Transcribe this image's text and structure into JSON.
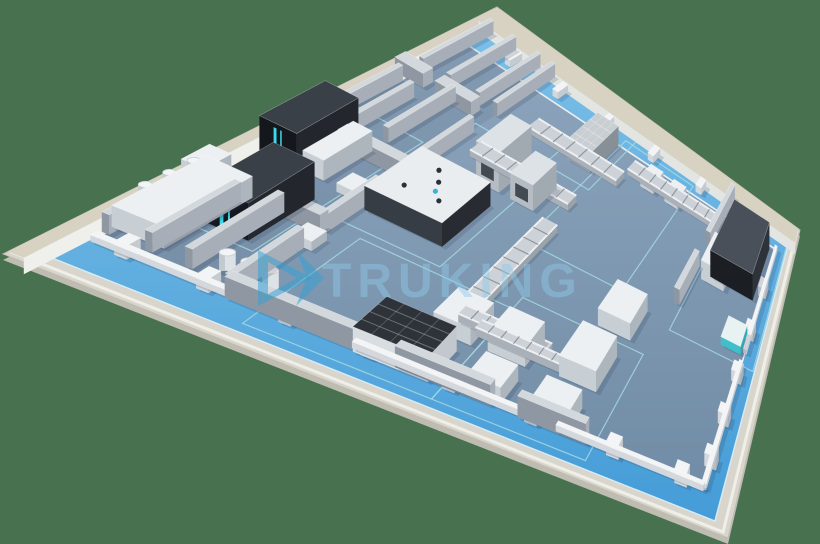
{
  "watermark": {
    "text": "TRUKING"
  },
  "scene": {
    "background_color": "#48714F",
    "corners": {
      "left": [
        3,
        254
      ],
      "top": [
        497,
        7
      ],
      "right": [
        800,
        230
      ],
      "bottom": [
        728,
        538
      ]
    },
    "colors": {
      "slab": "#D8D5CC",
      "slab_side": "#BFBCB2",
      "slab_lip": "#EFEEE7",
      "walkway_far": "#79BEE7",
      "walkway_near": "#459CD7",
      "walkway_line": "#D7ECF7",
      "floor_far": "#8CA4BC",
      "floor_near": "#708CA6",
      "floor_near_fix": "#718CA6",
      "curb": "#ECEEF0",
      "perimeter_top": "#D8D2C3",
      "perimeter_face": "#EFF0EB",
      "perimeter_face_far": "#E2E5E2",
      "marking": "#A5D8E2",
      "shadow": "rgba(35,50,70,0.17)",
      "glow": "#3FE3F6",
      "logo_blue": "#2E9FD6",
      "watermark_fill": "#8FCAEA"
    },
    "palettes": {
      "white": {
        "top": "#EDF0F2",
        "near": "#C7CED4",
        "side": "#ADB5BD"
      },
      "dark": {
        "top": "#3A4047",
        "near": "#14171C",
        "side": "#23272D"
      },
      "isolator": {
        "top": "#E9EDEF",
        "near": "#373D44",
        "side": "#282C32"
      },
      "frame": {
        "top": "#DDE2E6",
        "near": "#B5BCC3",
        "side": "#A1A9B1"
      },
      "crate": {
        "top": "#C9CED3",
        "near": "#99A1A9",
        "side": "#878F97"
      },
      "cartoner": {
        "top": "#4A5059",
        "near": "#1B1F24",
        "side": "#2E333A"
      },
      "agv": {
        "top": "#E8F2F2",
        "near": "#3FBFC9",
        "side": "#2FA9B4"
      },
      "tunnel": {
        "top": "#2E3339",
        "near": "#D8DDE1",
        "side": "#C2C8CE"
      },
      "wall": {
        "top": "#D3D8DD",
        "near": "#8F98A2",
        "side": "#A7AEB7"
      },
      "wallLow": {
        "top": "#F3F4F5",
        "near": "#D4D8DC",
        "side": "#C5CACF"
      }
    },
    "insets": {
      "walkway": {
        "u1": 0.022,
        "v1": 0.035,
        "u2": 0.978,
        "v2": 0.955
      },
      "floor": {
        "u1": 0.05,
        "v1": 0.115,
        "u2": 0.952,
        "v2": 0.9
      }
    },
    "perimeter_walls": [
      {
        "id": "perimeter-wall-left",
        "side": "u",
        "edge": 0.022,
        "band": 0.022,
        "h": 20
      },
      {
        "id": "perimeter-wall-far",
        "side": "v",
        "edge": 0.955,
        "band": 0.045,
        "h": 18
      }
    ],
    "rooms_walls": [
      {
        "id": "divider-wall-1",
        "u1": 0.25,
        "v1": 0.115,
        "u2": 0.25,
        "v2": 0.3
      },
      {
        "id": "divider-wall-2",
        "u1": 0.25,
        "v1": 0.36,
        "u2": 0.25,
        "v2": 0.5
      },
      {
        "id": "divider-wall-3",
        "u1": 0.25,
        "v1": 0.58,
        "u2": 0.25,
        "v2": 0.74
      },
      {
        "id": "divider-wall-4",
        "u1": 0.25,
        "v1": 0.8,
        "u2": 0.25,
        "v2": 0.95
      },
      {
        "id": "room-wall-h1",
        "u1": 0.03,
        "v1": 0.78,
        "u2": 0.1,
        "v2": 0.78
      },
      {
        "id": "room-wall-h2",
        "u1": 0.13,
        "v1": 0.78,
        "u2": 0.22,
        "v2": 0.78
      },
      {
        "id": "room-wall-h3",
        "u1": 0.03,
        "v1": 0.57,
        "u2": 0.09,
        "v2": 0.57
      },
      {
        "id": "room-wall-h4",
        "u1": 0.12,
        "v1": 0.57,
        "u2": 0.25,
        "v2": 0.57
      },
      {
        "id": "room-wall-h5",
        "u1": 0.03,
        "v1": 0.36,
        "u2": 0.12,
        "v2": 0.36
      },
      {
        "id": "room-wall-h6",
        "u1": 0.155,
        "v1": 0.36,
        "u2": 0.25,
        "v2": 0.36
      },
      {
        "id": "room-wall-v1",
        "u1": 0.055,
        "v1": 0.6,
        "u2": 0.055,
        "v2": 0.76
      },
      {
        "id": "room-wall-v2",
        "u1": 0.105,
        "v1": 0.6,
        "u2": 0.105,
        "v2": 0.74
      },
      {
        "id": "room-wall-v3",
        "u1": 0.165,
        "v1": 0.62,
        "u2": 0.165,
        "v2": 0.78
      },
      {
        "id": "room-wall-v4",
        "u1": 0.06,
        "v1": 0.8,
        "u2": 0.06,
        "v2": 0.95
      },
      {
        "id": "room-wall-v5",
        "u1": 0.13,
        "v1": 0.8,
        "u2": 0.13,
        "v2": 0.95
      },
      {
        "id": "room-wall-v6",
        "u1": 0.205,
        "v1": 0.8,
        "u2": 0.205,
        "v2": 0.95
      },
      {
        "id": "room-wall-v7",
        "u1": 0.05,
        "v1": 0.14,
        "u2": 0.05,
        "v2": 0.34
      },
      {
        "id": "room-wall-v8",
        "u1": 0.115,
        "v1": 0.14,
        "u2": 0.115,
        "v2": 0.34
      },
      {
        "id": "room-wall-v9",
        "u1": 0.175,
        "v1": 0.14,
        "u2": 0.175,
        "v2": 0.36
      },
      {
        "id": "hall-south-wall-1",
        "u1": 0.25,
        "v1": 0.115,
        "u2": 0.46,
        "v2": 0.115
      },
      {
        "id": "hall-south-wall-2",
        "u1": 0.5,
        "v1": 0.115,
        "u2": 0.64,
        "v2": 0.115
      },
      {
        "id": "hall-south-wall-3",
        "u1": 0.68,
        "v1": 0.115,
        "u2": 0.78,
        "v2": 0.115
      },
      {
        "id": "packaging-room-wall-1",
        "u1": 0.8,
        "v1": 0.6,
        "u2": 0.8,
        "v2": 0.73
      },
      {
        "id": "packaging-room-wall-2",
        "u1": 0.8,
        "v1": 0.8,
        "u2": 0.8,
        "v2": 0.96
      }
    ],
    "curbs": [
      {
        "id": "south-curb-1",
        "u1": 0.05,
        "v1": 0.115,
        "u2": 0.4,
        "v2": 0.115
      },
      {
        "id": "south-curb-2",
        "u1": 0.435,
        "v1": 0.115,
        "u2": 0.7,
        "v2": 0.115
      },
      {
        "id": "south-curb-3",
        "u1": 0.735,
        "v1": 0.115,
        "u2": 0.952,
        "v2": 0.115
      },
      {
        "id": "east-curb-1",
        "u1": 0.952,
        "v1": 0.115,
        "u2": 0.952,
        "v2": 0.52
      },
      {
        "id": "east-curb-2",
        "u1": 0.952,
        "v1": 0.56,
        "u2": 0.952,
        "v2": 0.9
      }
    ],
    "pillars": {
      "south_v": 0.115,
      "south_u": [
        0.1,
        0.22,
        0.34,
        0.46,
        0.58,
        0.7,
        0.82,
        0.92
      ],
      "east_u": 0.952,
      "east_v": [
        0.2,
        0.34,
        0.48,
        0.62,
        0.76
      ],
      "far_v": 0.925,
      "far_u": [
        0.16,
        0.3,
        0.44,
        0.58,
        0.72,
        0.86
      ]
    },
    "markings": [
      {
        "id": "marking-freeze-dry-zone",
        "u1": 0.035,
        "v1": 0.24,
        "u2": 0.21,
        "v2": 0.66
      },
      {
        "id": "marking-isolator-zone",
        "u1": 0.24,
        "v1": 0.4,
        "u2": 0.43,
        "v2": 0.76
      },
      {
        "id": "marking-wash-zone",
        "u1": 0.3,
        "v1": 0.06,
        "u2": 0.57,
        "v2": 0.38
      },
      {
        "id": "marking-fill-zone",
        "u1": 0.57,
        "v1": 0.06,
        "u2": 0.79,
        "v2": 0.42
      },
      {
        "id": "marking-conveyor-zone",
        "u1": 0.5,
        "v1": 0.56,
        "u2": 0.7,
        "v2": 0.92
      },
      {
        "id": "marking-packaging-zone",
        "u1": 0.81,
        "v1": 0.52,
        "u2": 0.975,
        "v2": 0.95
      },
      {
        "id": "marking-crate-zone",
        "u1": 0.41,
        "v1": 0.76,
        "u2": 0.52,
        "v2": 0.94
      }
    ],
    "machines": [
      {
        "id": "preparation-system",
        "type": "box",
        "u1": 0.045,
        "v1": 0.16,
        "u2": 0.125,
        "v2": 0.36,
        "h": 22,
        "pal": "white"
      },
      {
        "id": "preparation-tower",
        "type": "box",
        "u1": 0.05,
        "v1": 0.3,
        "u2": 0.088,
        "v2": 0.36,
        "h": 36,
        "pal": "white"
      },
      {
        "id": "preparation-tanks",
        "type": "tanks",
        "axis": "v",
        "u": 0.068,
        "pos": [
          0.2,
          0.252,
          0.304
        ],
        "r": 7,
        "h": 16,
        "lift": 22
      },
      {
        "id": "freeze-dryer-2",
        "type": "box",
        "u1": 0.115,
        "v1": 0.26,
        "u2": 0.19,
        "v2": 0.42,
        "h": 40,
        "pal": "dark",
        "glow": true
      },
      {
        "id": "freeze-dryer-1",
        "type": "box",
        "u1": 0.055,
        "v1": 0.46,
        "u2": 0.125,
        "v2": 0.6,
        "h": 46,
        "pal": "dark",
        "glow": true
      },
      {
        "id": "freeze-dryer-cabinet",
        "type": "box",
        "u1": 0.128,
        "v1": 0.47,
        "u2": 0.168,
        "v2": 0.585,
        "h": 24,
        "pal": "white"
      },
      {
        "id": "buffer-tanks",
        "type": "tanks",
        "axis": "u",
        "v": 0.17,
        "pos": [
          0.215,
          0.248,
          0.281
        ],
        "r": 8,
        "h": 18,
        "lift": 0
      },
      {
        "id": "filling-isolator",
        "type": "box",
        "u1": 0.26,
        "v1": 0.45,
        "u2": 0.405,
        "v2": 0.6,
        "h": 28,
        "pal": "isolator",
        "robots": true
      },
      {
        "id": "transfer-tower",
        "type": "box",
        "u1": 0.345,
        "v1": 0.64,
        "u2": 0.395,
        "v2": 0.74,
        "h": 52,
        "pal": "frame",
        "window": true
      },
      {
        "id": "gantry-frame",
        "type": "box",
        "u1": 0.42,
        "v1": 0.64,
        "u2": 0.47,
        "v2": 0.72,
        "h": 34,
        "pal": "frame",
        "window": true
      },
      {
        "id": "conveyor-ladder-1",
        "type": "ladder",
        "u1": 0.295,
        "v1": 0.685,
        "u2": 0.52,
        "v2": 0.715
      },
      {
        "id": "conveyor-ladder-2",
        "type": "ladder",
        "u1": 0.33,
        "v1": 0.805,
        "u2": 0.56,
        "v2": 0.835
      },
      {
        "id": "conveyor-ladder-3",
        "type": "ladder",
        "u1": 0.505,
        "v1": 0.3,
        "u2": 0.535,
        "v2": 0.62
      },
      {
        "id": "conveyor-ladder-4",
        "type": "ladder",
        "u1": 0.52,
        "v1": 0.285,
        "u2": 0.665,
        "v2": 0.315
      },
      {
        "id": "crate-stack",
        "type": "box",
        "u1": 0.435,
        "v1": 0.8,
        "u2": 0.495,
        "v2": 0.9,
        "h": 28,
        "pal": "crate",
        "grid": true
      },
      {
        "id": "carton-conveyor",
        "type": "ladder",
        "u1": 0.56,
        "v1": 0.848,
        "u2": 0.8,
        "v2": 0.876
      },
      {
        "id": "carton-box-1",
        "type": "box",
        "u1": 0.6,
        "v1": 0.84,
        "u2": 0.635,
        "v2": 0.885,
        "h": 14,
        "pal": "white"
      },
      {
        "id": "carton-box-2",
        "type": "box",
        "u1": 0.665,
        "v1": 0.84,
        "u2": 0.7,
        "v2": 0.885,
        "h": 14,
        "pal": "white"
      },
      {
        "id": "cartoning-machine",
        "type": "box",
        "u1": 0.835,
        "v1": 0.72,
        "u2": 0.935,
        "v2": 0.89,
        "h": 38,
        "pal": "cartoner"
      },
      {
        "id": "cartoning-feeder",
        "type": "box",
        "u1": 0.82,
        "v1": 0.7,
        "u2": 0.872,
        "v2": 0.795,
        "h": 26,
        "pal": "white"
      },
      {
        "id": "agv-cart",
        "type": "box",
        "u1": 0.905,
        "v1": 0.55,
        "u2": 0.945,
        "v2": 0.62,
        "h": 10,
        "pal": "agv"
      },
      {
        "id": "sterilization-tunnel",
        "type": "box",
        "u1": 0.44,
        "v1": 0.1,
        "u2": 0.55,
        "v2": 0.21,
        "h": 24,
        "pal": "tunnel",
        "grid": true
      },
      {
        "id": "washing-machine",
        "type": "box",
        "u1": 0.5,
        "v1": 0.24,
        "u2": 0.56,
        "v2": 0.33,
        "h": 18,
        "pal": "white"
      },
      {
        "id": "wash-conveyor",
        "type": "ladder",
        "u1": 0.555,
        "v1": 0.27,
        "u2": 0.7,
        "v2": 0.295
      },
      {
        "id": "filling-machine-1",
        "type": "box",
        "u1": 0.585,
        "v1": 0.245,
        "u2": 0.645,
        "v2": 0.335,
        "h": 20,
        "pal": "white"
      },
      {
        "id": "filling-machine-2",
        "type": "box",
        "u1": 0.6,
        "v1": 0.12,
        "u2": 0.65,
        "v2": 0.2,
        "h": 16,
        "pal": "white"
      },
      {
        "id": "capping-machine",
        "type": "box",
        "u1": 0.695,
        "v1": 0.26,
        "u2": 0.755,
        "v2": 0.38,
        "h": 22,
        "pal": "white"
      },
      {
        "id": "labeling-machine",
        "type": "box",
        "u1": 0.695,
        "v1": 0.12,
        "u2": 0.75,
        "v2": 0.2,
        "h": 18,
        "pal": "white"
      },
      {
        "id": "inspection-machine",
        "type": "box",
        "u1": 0.7,
        "v1": 0.44,
        "u2": 0.76,
        "v2": 0.54,
        "h": 20,
        "pal": "white"
      },
      {
        "id": "transfer-cart",
        "type": "box",
        "u1": 0.2,
        "v1": 0.46,
        "u2": 0.23,
        "v2": 0.5,
        "h": 10,
        "pal": "white"
      },
      {
        "id": "utility-unit",
        "type": "box",
        "u1": 0.235,
        "v1": 0.3,
        "u2": 0.268,
        "v2": 0.34,
        "h": 10,
        "pal": "white"
      }
    ],
    "watermark_layout": {
      "text_x": 322,
      "text_y": 297,
      "font_size": 48,
      "opacity": 0.45,
      "logo": {
        "outer": [
          [
            258,
            250
          ],
          [
            258,
            306
          ],
          [
            312,
            278
          ]
        ],
        "inner": [
          [
            268,
            262
          ],
          [
            268,
            294
          ],
          [
            297,
            278
          ]
        ],
        "arrow": [
          [
            296,
            250
          ],
          [
            324,
            278
          ],
          [
            296,
            306
          ],
          [
            307,
            278
          ]
        ],
        "opacity": 0.5
      }
    }
  }
}
